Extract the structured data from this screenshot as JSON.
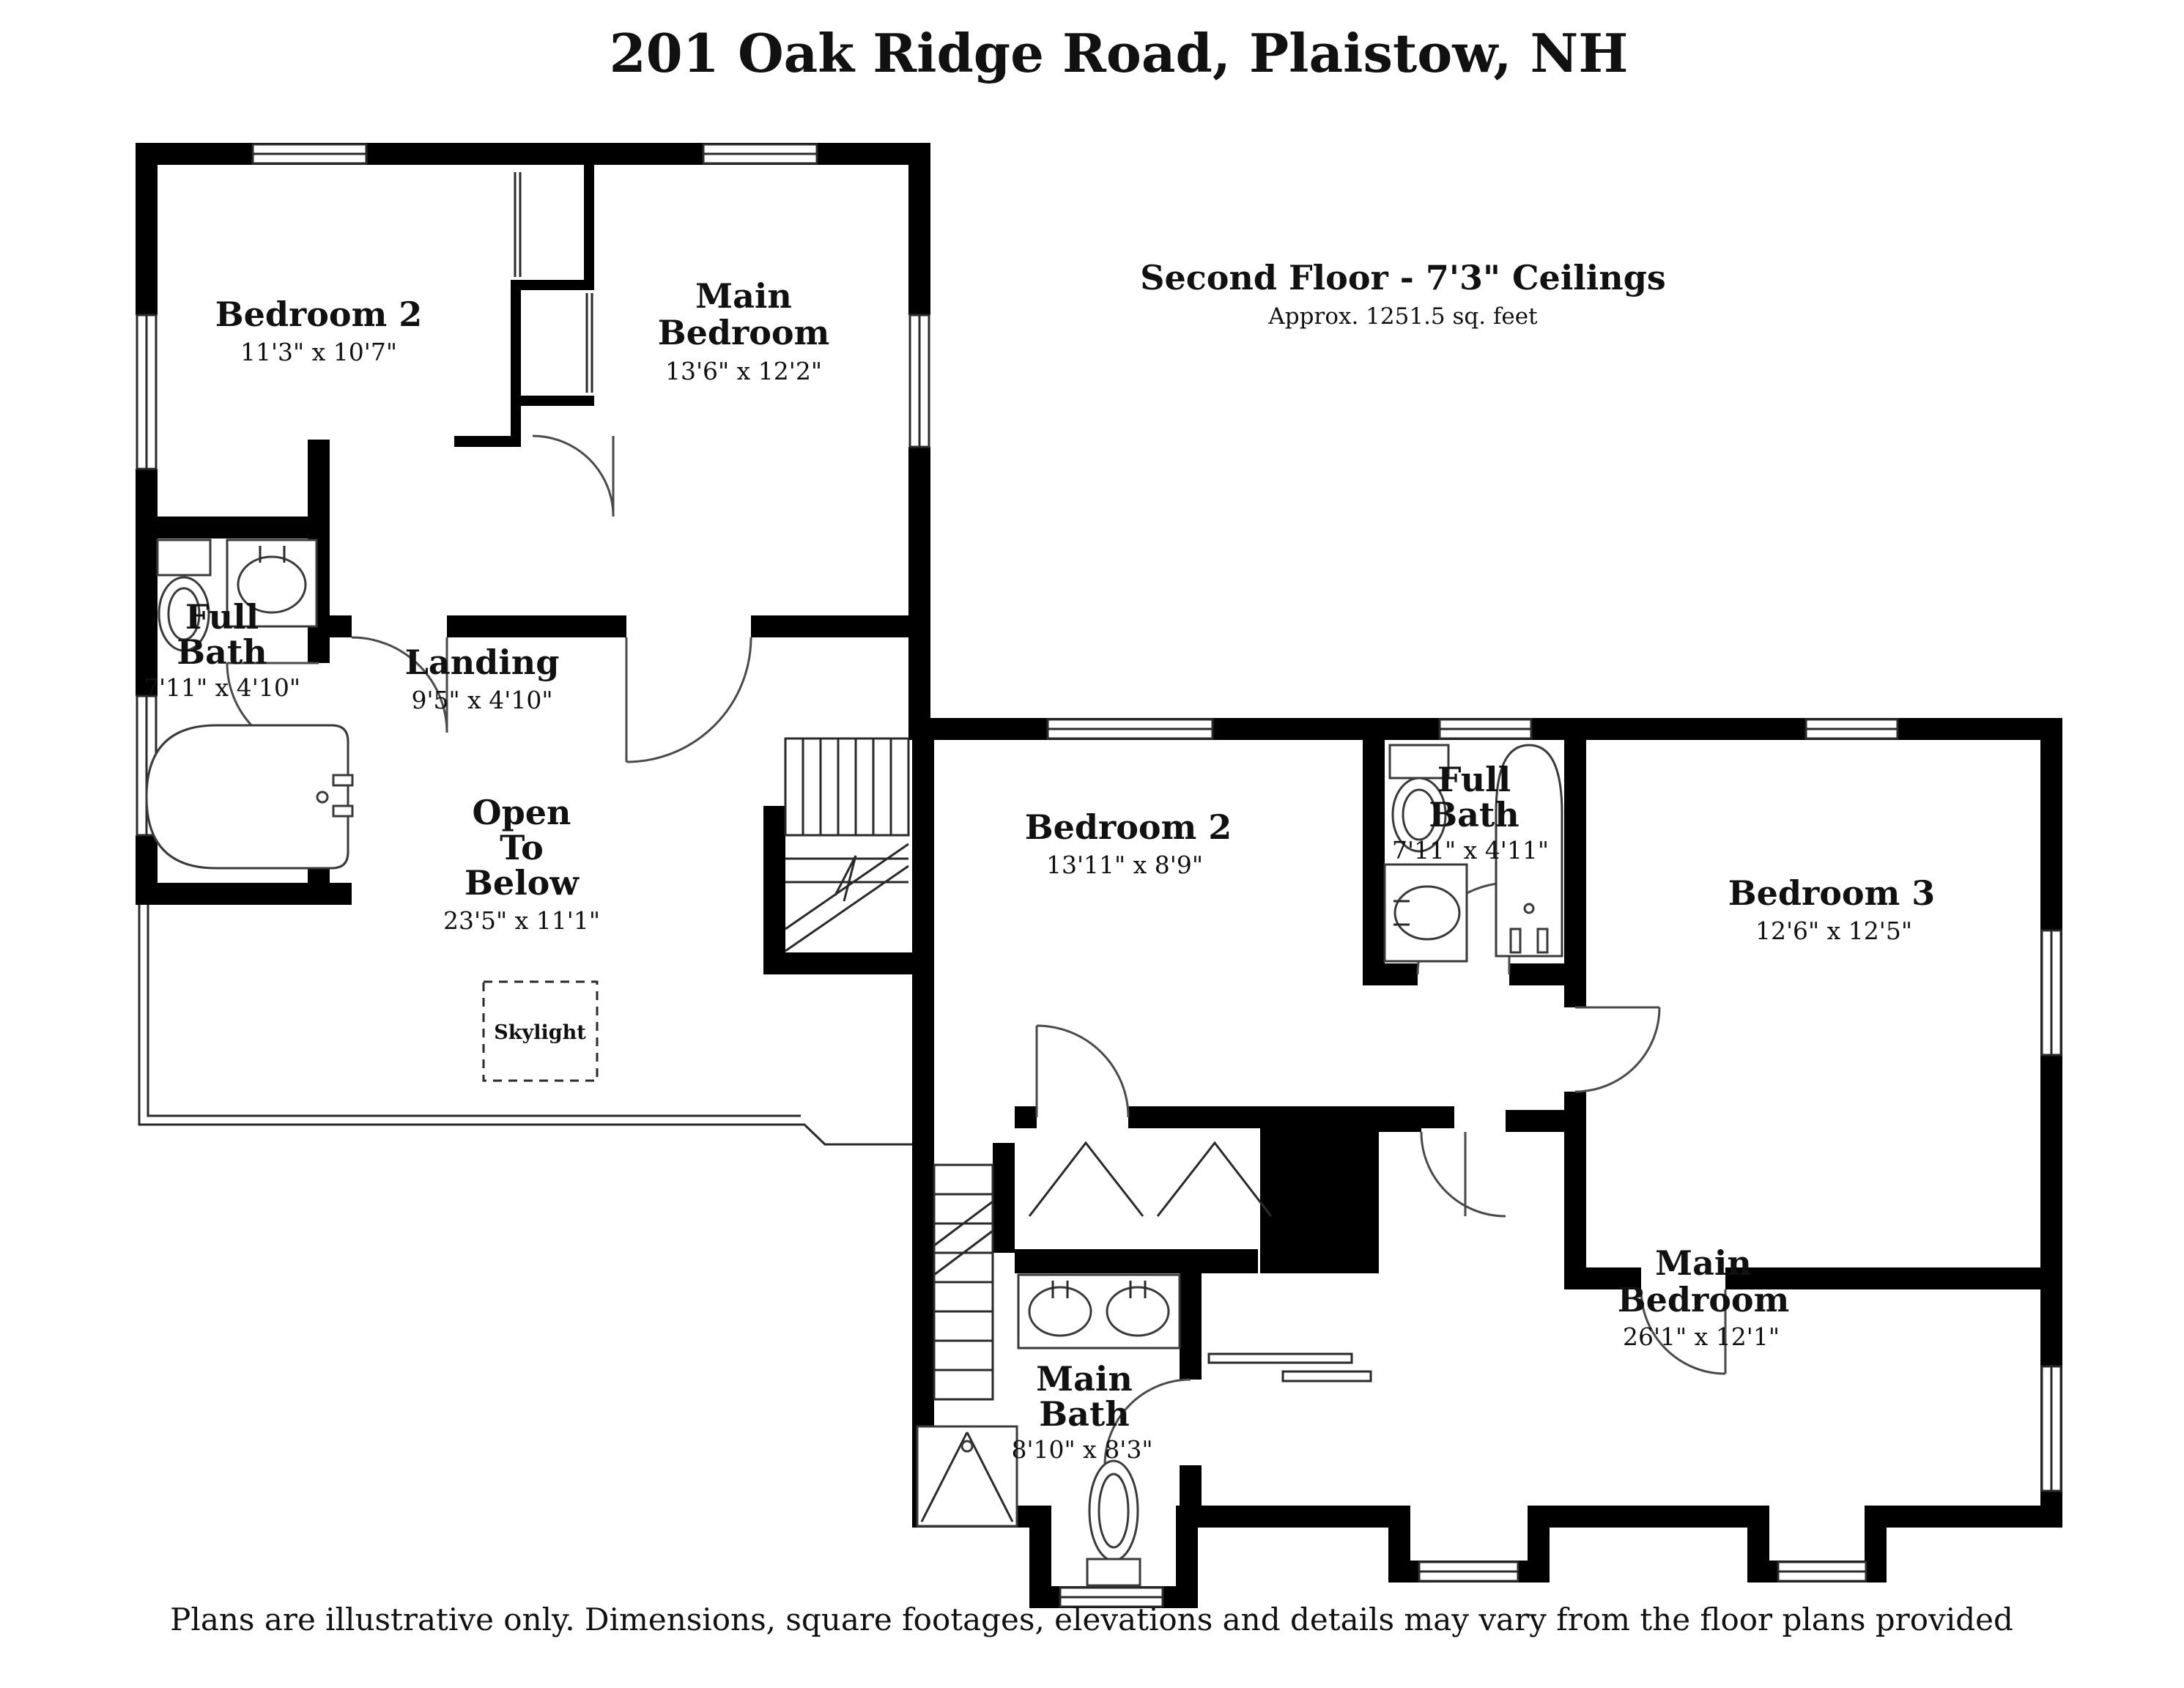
{
  "title": "201 Oak Ridge Road, Plaistow, NH",
  "floor": {
    "heading": "Second Floor - 7'3\" Ceilings",
    "subheading": "Approx. 1251.5 sq. feet"
  },
  "rooms": {
    "bedroom2_upper": {
      "name": "Bedroom 2",
      "dims": "11'3\" x 10'7\""
    },
    "main_bedroom_upper": {
      "line1": "Main",
      "line2": "Bedroom",
      "dims": "13'6\" x 12'2\""
    },
    "full_bath_upper": {
      "line1": "Full",
      "line2": "Bath",
      "dims": "7'11\" x 4'10\""
    },
    "landing": {
      "name": "Landing",
      "dims": "9'5\" x 4'10\""
    },
    "open_to_below": {
      "line1": "Open",
      "line2": "To",
      "line3": "Below",
      "dims": "23'5\" x 11'1\""
    },
    "skylight": {
      "name": "Skylight"
    },
    "bedroom2_lower": {
      "name": "Bedroom 2",
      "dims": "13'11\" x 8'9\""
    },
    "full_bath_lower": {
      "line1": "Full",
      "line2": "Bath",
      "dims": "7'11\" x 4'11\""
    },
    "bedroom3": {
      "name": "Bedroom 3",
      "dims": "12'6\" x 12'5\""
    },
    "main_bedroom_lower": {
      "line1": "Main",
      "line2": "Bedroom",
      "dims": "26'1\" x 12'1\""
    },
    "main_bath": {
      "line1": "Main",
      "line2": "Bath",
      "dims": "8'10\" x 8'3\""
    }
  },
  "footer": "Plans are illustrative only. Dimensions, square footages, elevations and details may vary from the floor plans provided",
  "colors": {
    "wall": "#000000",
    "background": "#ffffff",
    "text": "#111111"
  }
}
